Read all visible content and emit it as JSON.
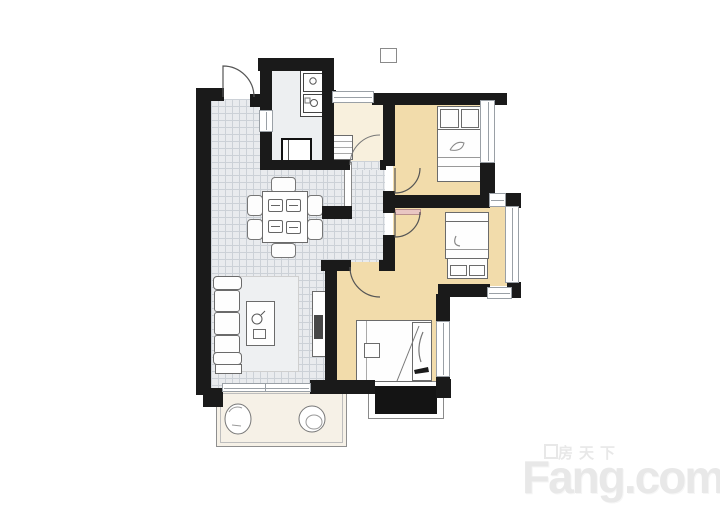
{
  "watermark": {
    "brand_cn": "房天下",
    "brand_en": "Fang.com"
  },
  "palette": {
    "wall": "#1a1a1a",
    "tile": "#e9ebee",
    "tile_line": "#ccd1d7",
    "kitchen_floor": "#edeff1",
    "bath_floor": "#f8f0dd",
    "bedroom_floor": "#f2dcab",
    "balcony_floor": "#f6f1e7",
    "rug": "#eef0f2",
    "furniture_fill": "#fefefe",
    "furniture_stroke": "#6b6b6b",
    "dark_fill": "#141414",
    "shelf_pink": "#e9c6c3",
    "watermark_color": "#e8e8e8"
  }
}
